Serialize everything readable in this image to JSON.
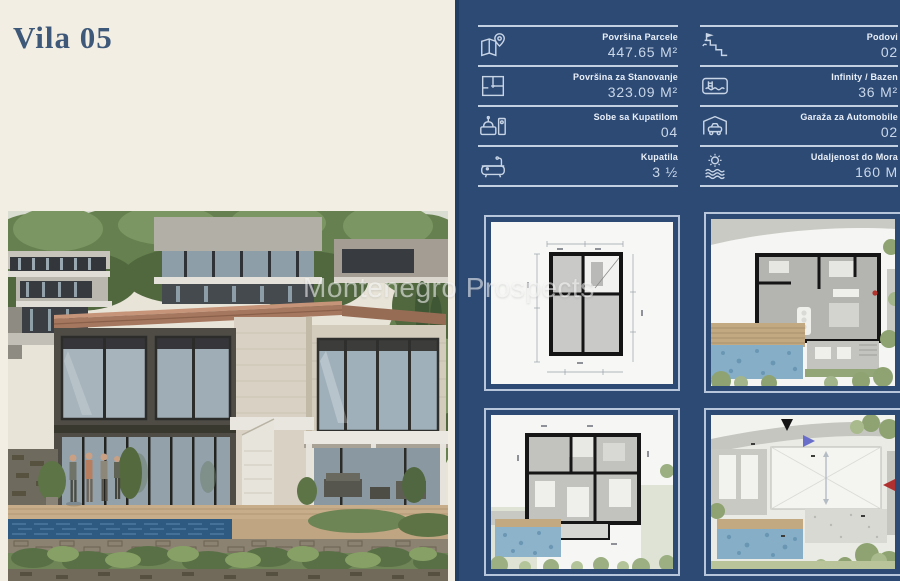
{
  "page": {
    "title": "Vila 05",
    "watermark": "Montenegro Prospects"
  },
  "colors": {
    "panel_navy": "#2d4a74",
    "panel_edge": "#223f63",
    "cream_background": "#f3eee4",
    "title_blue": "#3d5878",
    "divider_line": "#c3d0e2",
    "thumb_frame": "#b7c6db",
    "pool_blue": "#86aec7",
    "label_text": "#eaf0f9",
    "value_text": "#c9d7e9"
  },
  "specs": {
    "left_column": [
      {
        "icon": "map-area-icon",
        "label": "Površina Parcele",
        "value": "447.65 M²"
      },
      {
        "icon": "floor-plan-icon",
        "label": "Površina za Stanovanje",
        "value": "323.09 M²"
      },
      {
        "icon": "bedroom-icon",
        "label": "Sobe sa Kupatilom",
        "value": "04"
      },
      {
        "icon": "bathtub-icon",
        "label": "Kupatila",
        "value": "3 ½"
      }
    ],
    "right_column": [
      {
        "icon": "stairs-icon",
        "label": "Podovi",
        "value": "02"
      },
      {
        "icon": "pool-icon",
        "label": "Infinity / Bazen",
        "value": "36 M²"
      },
      {
        "icon": "garage-icon",
        "label": "Garaža za Automobile",
        "value": "02"
      },
      {
        "icon": "sun-waves-icon",
        "label": "Udaljenost do Mora",
        "value": "160 M"
      }
    ]
  },
  "floor_plans": [
    {
      "name": "basement-plan-thumbnail"
    },
    {
      "name": "ground-floor-plan-thumbnail"
    },
    {
      "name": "upper-floor-plan-thumbnail"
    },
    {
      "name": "roof-plan-thumbnail"
    }
  ]
}
